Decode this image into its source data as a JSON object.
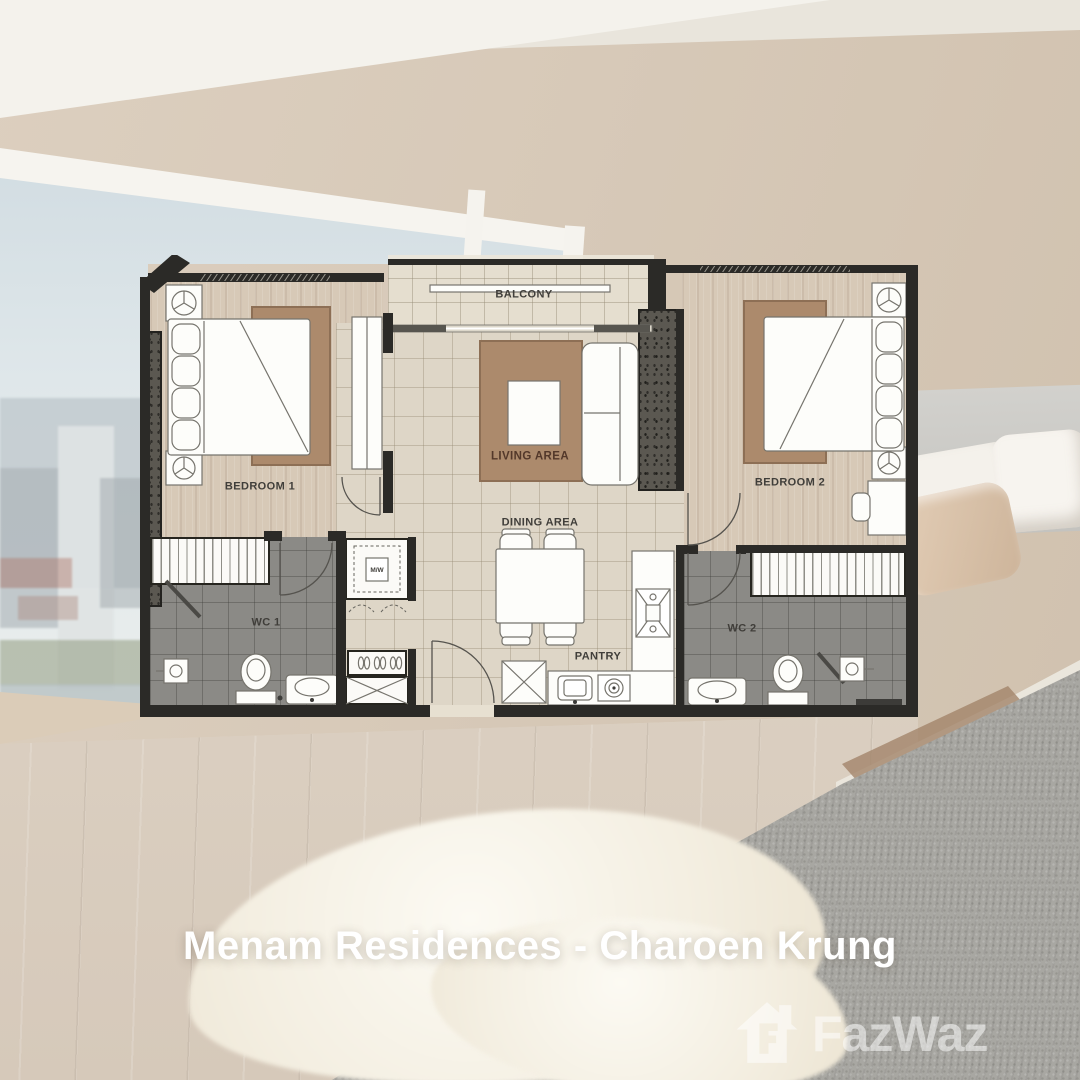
{
  "title": "Menam Residences - Charoen Krung",
  "watermark": {
    "brand": "FazWaz",
    "icon": "house-logo-icon"
  },
  "floorplan": {
    "labels": {
      "balcony": "BALCONY",
      "bedroom1": "BEDROOM 1",
      "bedroom2": "BEDROOM 2",
      "living": "LIVING AREA",
      "dining": "DINING AREA",
      "pantry": "PANTRY",
      "wc1": "WC 1",
      "wc2": "WC 2",
      "microwave": "M/W"
    },
    "colors": {
      "wall": "#2b2a27",
      "wood": "#d7c9b7",
      "tile": "#ded6c7",
      "balcony": "#e5decf",
      "wc": "#8b8a86",
      "rug": "#ac8a6c",
      "label": "#403e3a",
      "living_label": "#53382a"
    }
  }
}
